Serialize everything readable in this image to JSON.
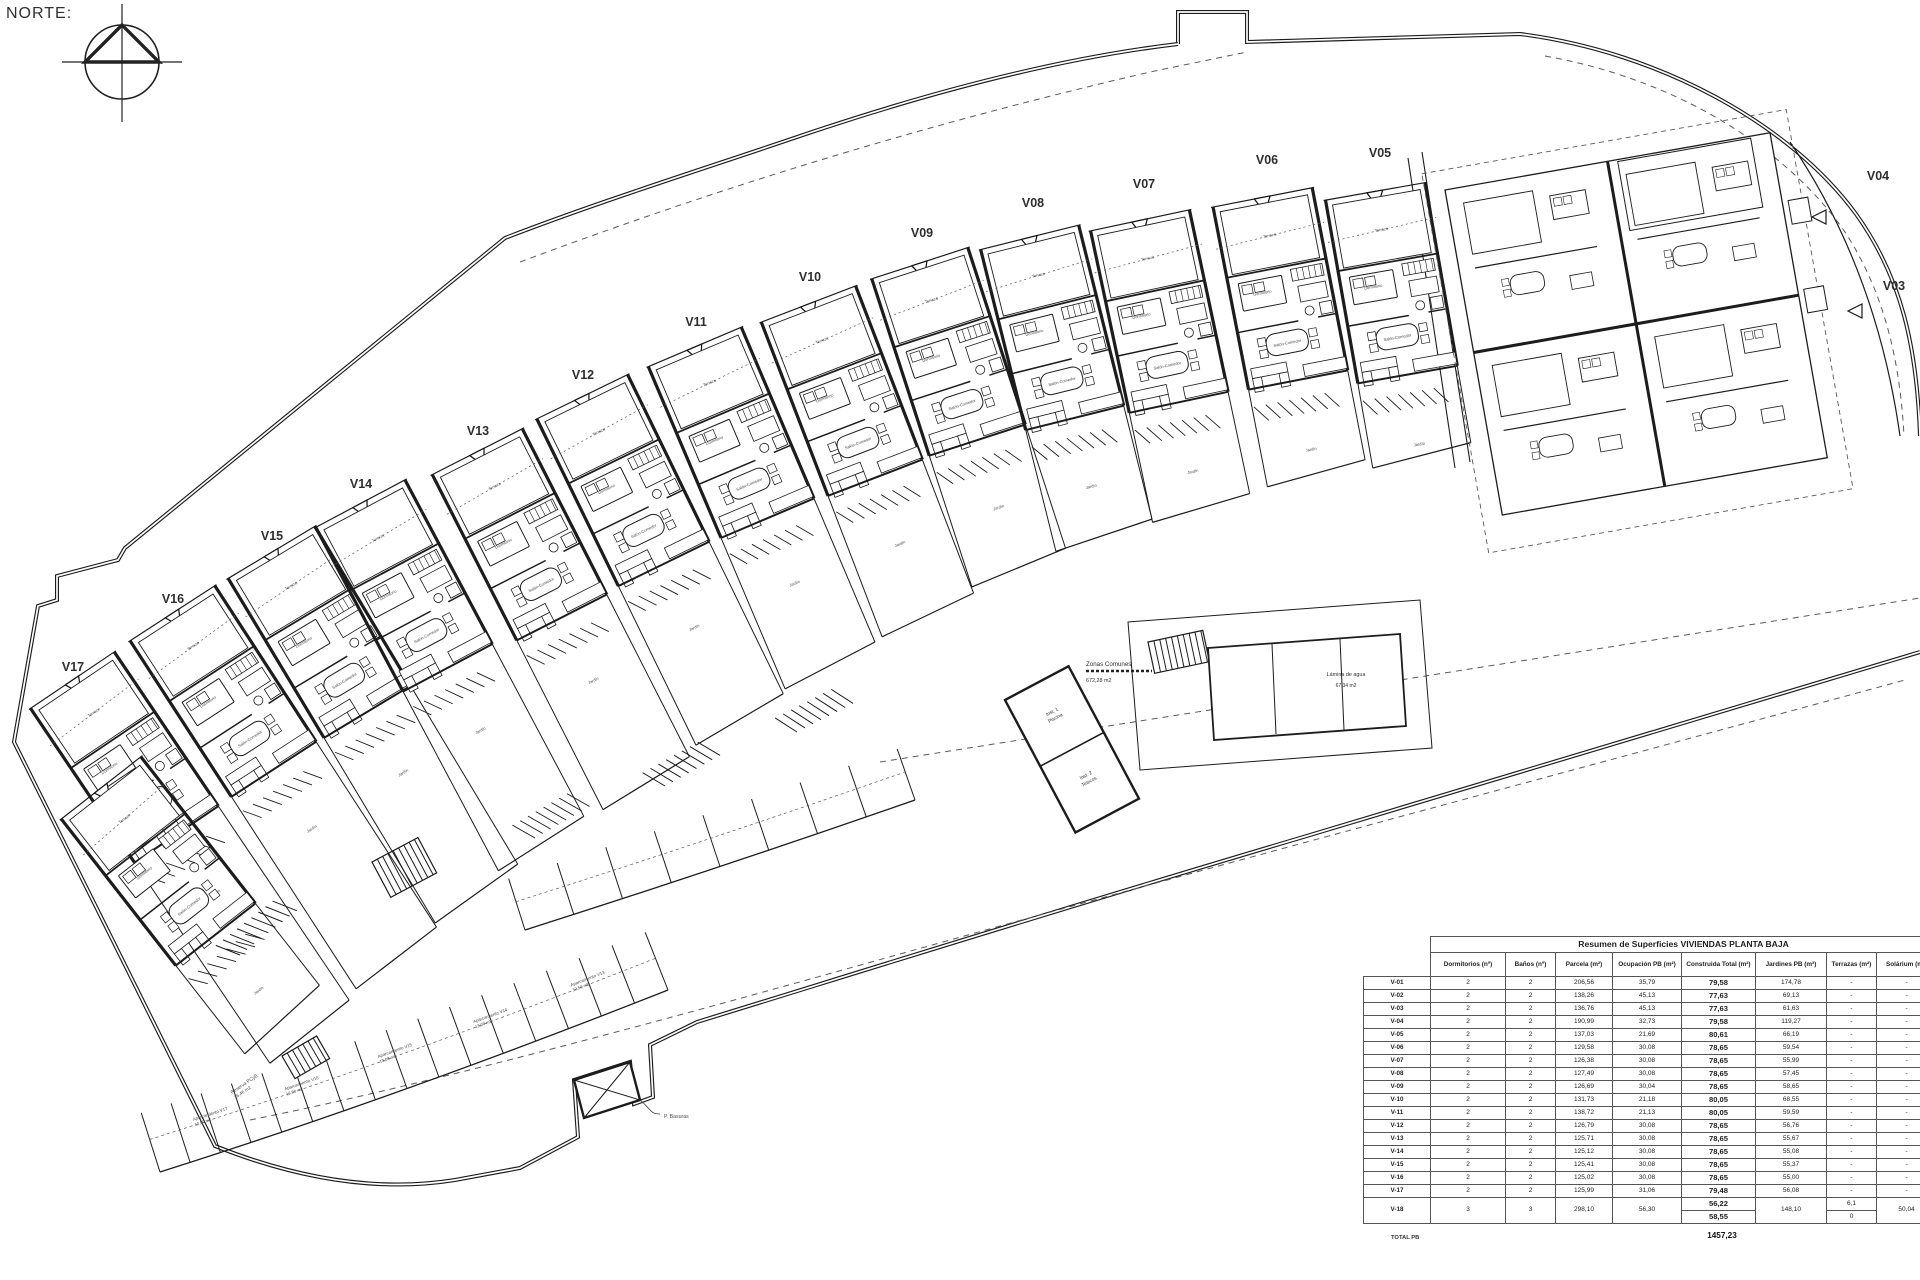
{
  "north_label": "NORTE:",
  "villas": {
    "band": [
      "V17",
      "V16",
      "V15",
      "V14",
      "V13",
      "V12",
      "V11",
      "V10",
      "V09",
      "V08",
      "V07",
      "V06",
      "V05"
    ],
    "right": [
      "V04",
      "V03"
    ]
  },
  "common": {
    "zonas_title": "Zonas Comunes",
    "zonas_area": "672,28 m2",
    "water_title": "Lámina de agua",
    "water_area": "67,34 m2",
    "inst1_line1": "Inst. 1",
    "inst1_line2": "Piscina",
    "inst2_line1": "Inst. 2",
    "inst2_line2": "Telecos",
    "basuras": "P. Basuras",
    "reserva_line1": "Reserva PCyB",
    "reserva_line2": "26,46 m2"
  },
  "rooms": {
    "terrace": "Terraza",
    "bedroom": "Dormitorio",
    "living": "Salón-Comedor",
    "garden": "Jardín"
  },
  "parking": {
    "labels": [
      {
        "name": "Aparcamiento V17",
        "area": "12,50 m2"
      },
      {
        "name": "Aparcamiento V16",
        "area": "13,50 m2"
      },
      {
        "name": "Aparcamiento V15",
        "area": "13,08 m2"
      },
      {
        "name": "Aparcamiento V14",
        "area": "13,08 m2"
      },
      {
        "name": "Aparcamiento V13",
        "area": "12,50 m2"
      }
    ]
  },
  "table": {
    "title": "Resumen de Superficies VIVIENDAS PLANTA BAJA",
    "columns": [
      "Dormitorios (nº)",
      "Baños (nº)",
      "Parcela (m²)",
      "Ocupación PB (m²)",
      "Construida Total (m²)",
      "Jardines PB (m²)",
      "Terrazas (m²)",
      "Solárium (m²)"
    ],
    "rows": [
      [
        "V-01",
        "2",
        "2",
        "206,56",
        "35,79",
        "79,58",
        "174,78",
        "-",
        "-"
      ],
      [
        "V-02",
        "2",
        "2",
        "138,26",
        "45,13",
        "77,63",
        "69,13",
        "-",
        "-"
      ],
      [
        "V-03",
        "2",
        "2",
        "136,76",
        "45,13",
        "77,63",
        "61,63",
        "-",
        "-"
      ],
      [
        "V-04",
        "2",
        "2",
        "190,99",
        "32,73",
        "79,58",
        "119,27",
        "-",
        "-"
      ],
      [
        "V-05",
        "2",
        "2",
        "137,03",
        "21,69",
        "80,61",
        "66,19",
        "-",
        "-"
      ],
      [
        "V-06",
        "2",
        "2",
        "129,58",
        "30,08",
        "78,65",
        "59,54",
        "-",
        "-"
      ],
      [
        "V-07",
        "2",
        "2",
        "126,38",
        "30,08",
        "78,65",
        "55,99",
        "-",
        "-"
      ],
      [
        "V-08",
        "2",
        "2",
        "127,49",
        "30,08",
        "78,65",
        "57,45",
        "-",
        "-"
      ],
      [
        "V-09",
        "2",
        "2",
        "126,69",
        "30,04",
        "78,65",
        "58,65",
        "-",
        "-"
      ],
      [
        "V-10",
        "2",
        "2",
        "131,73",
        "21,18",
        "80,05",
        "68,55",
        "-",
        "-"
      ],
      [
        "V-11",
        "2",
        "2",
        "138,72",
        "21,13",
        "80,05",
        "59,59",
        "-",
        "-"
      ],
      [
        "V-12",
        "2",
        "2",
        "126,79",
        "30,08",
        "78,65",
        "56,76",
        "-",
        "-"
      ],
      [
        "V-13",
        "2",
        "2",
        "125,71",
        "30,08",
        "78,65",
        "55,67",
        "-",
        "-"
      ],
      [
        "V-14",
        "2",
        "2",
        "125,12",
        "30,08",
        "78,65",
        "55,08",
        "-",
        "-"
      ],
      [
        "V-15",
        "2",
        "2",
        "125,41",
        "30,08",
        "78,65",
        "55,37",
        "-",
        "-"
      ],
      [
        "V-16",
        "2",
        "2",
        "125,02",
        "30,08",
        "78,65",
        "55,00",
        "-",
        "-"
      ],
      [
        "V-17",
        "2",
        "2",
        "125,99",
        "31,06",
        "79,48",
        "56,08",
        "-",
        "-"
      ]
    ],
    "v18": {
      "id": "V-18",
      "dorm": "3",
      "banos": "3",
      "parcela": "298,10",
      "ocupacion": "56,30",
      "construida": [
        "56,22",
        "58,55"
      ],
      "jardines": "148,10",
      "terrazas": [
        "6,1",
        "0"
      ],
      "solarium": "50,04"
    },
    "total_label": "TOTAL PB",
    "total_value": "1457,23"
  },
  "colors": {
    "line": "#1c1c1c",
    "dash": "#5a5a5a",
    "text": "#303030"
  }
}
